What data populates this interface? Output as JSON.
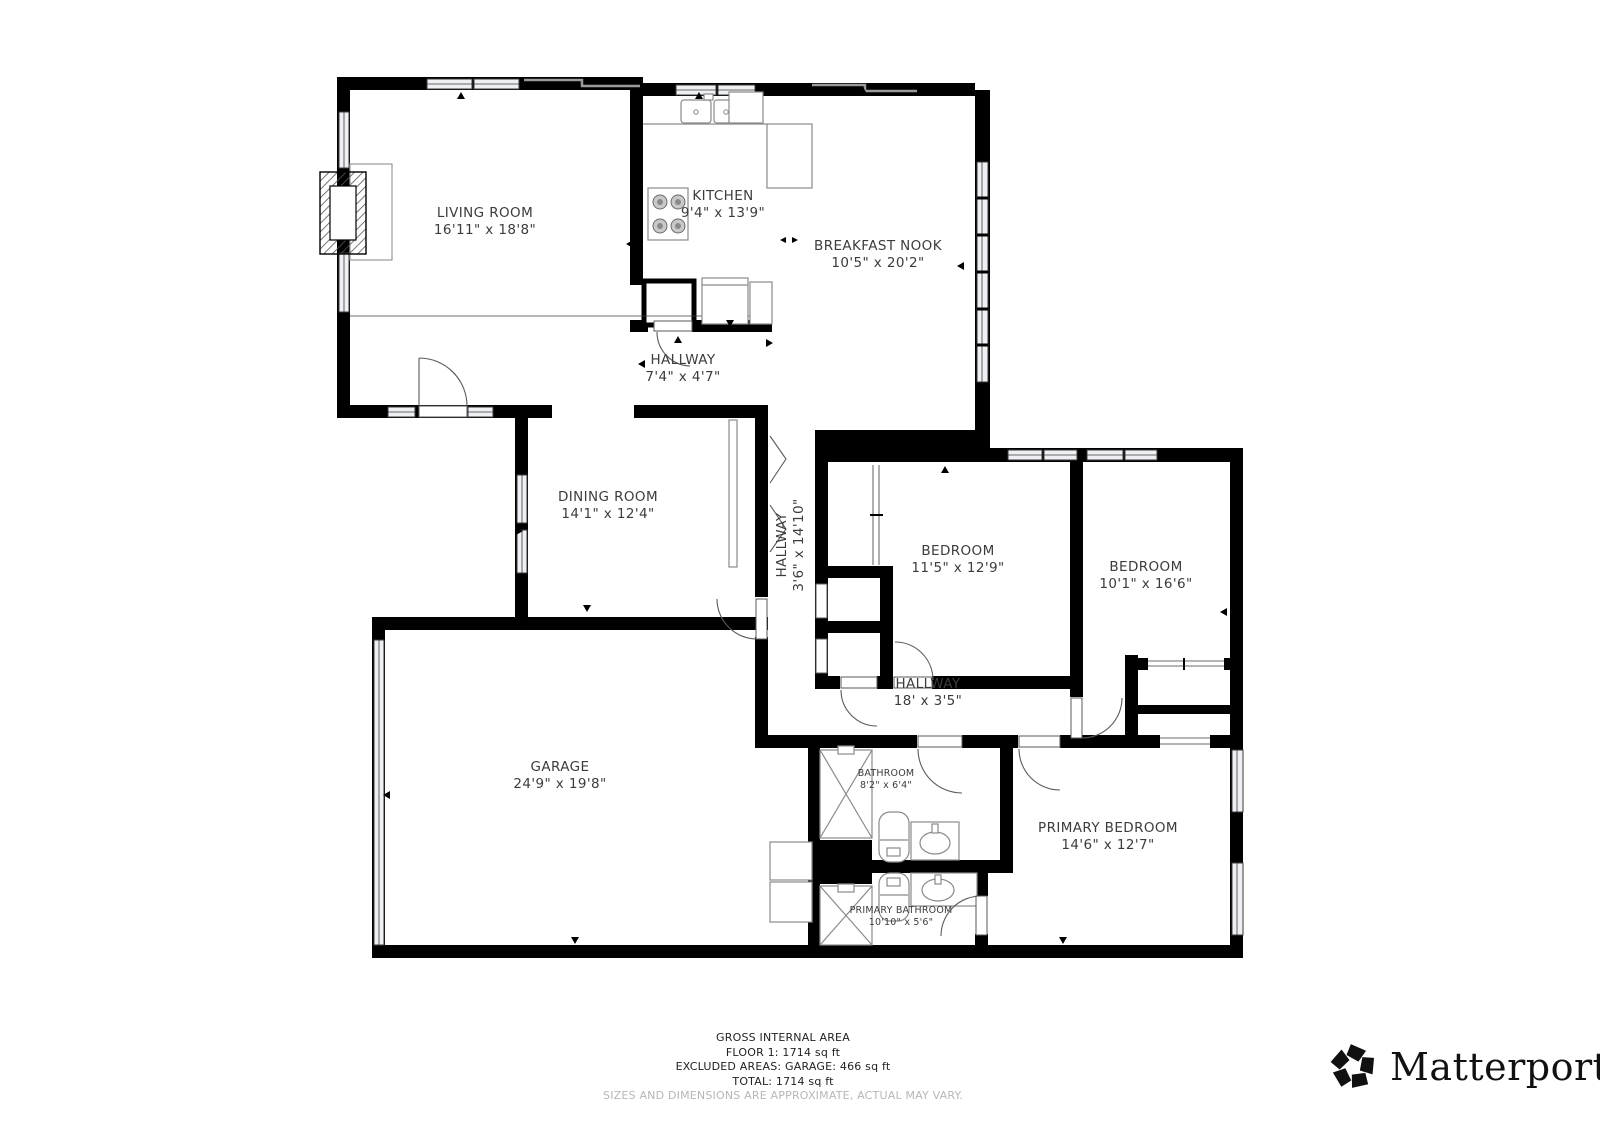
{
  "rooms": [
    {
      "id": "living-room",
      "name": "LIVING ROOM",
      "dims": "16'11\" x 18'8\""
    },
    {
      "id": "kitchen",
      "name": "KITCHEN",
      "dims": "9'4\" x 13'9\""
    },
    {
      "id": "breakfast-nook",
      "name": "BREAKFAST NOOK",
      "dims": "10'5\" x 20'2\""
    },
    {
      "id": "hallway-north",
      "name": "HALLWAY",
      "dims": "7'4\" x 4'7\""
    },
    {
      "id": "dining-room",
      "name": "DINING ROOM",
      "dims": "14'1\" x 12'4\""
    },
    {
      "id": "hallway-vertical",
      "name": "HALLWAY",
      "dims": "3'6\" x 14'10\""
    },
    {
      "id": "bedroom-1",
      "name": "BEDROOM",
      "dims": "11'5\" x 12'9\""
    },
    {
      "id": "bedroom-2",
      "name": "BEDROOM",
      "dims": "10'1\" x 16'6\""
    },
    {
      "id": "hallway-south",
      "name": "HALLWAY",
      "dims": "18' x 3'5\""
    },
    {
      "id": "garage",
      "name": "GARAGE",
      "dims": "24'9\" x 19'8\""
    },
    {
      "id": "bathroom",
      "name": "BATHROOM",
      "dims": "8'2\" x 6'4\""
    },
    {
      "id": "primary-bedroom",
      "name": "PRIMARY BEDROOM",
      "dims": "14'6\" x 12'7\""
    },
    {
      "id": "primary-bathroom",
      "name": "PRIMARY BATHROOM",
      "dims": "10'10\" x 5'6\""
    }
  ],
  "footer": {
    "line1": "GROSS INTERNAL AREA",
    "line2": "FLOOR 1: 1714 sq ft",
    "line3": "EXCLUDED AREAS: GARAGE: 466 sq ft",
    "line4": "TOTAL: 1714 sq ft",
    "disclaimer": "SIZES AND DIMENSIONS ARE APPROXIMATE, ACTUAL MAY VARY."
  },
  "brand": {
    "name": "Matterport",
    "registered": "®"
  },
  "colors": {
    "wall": "#000000",
    "label": "#3c3c3c",
    "disclaimer": "#b3b8b6",
    "winfill": "#eef0f4",
    "fixture": "#8a8a8a"
  }
}
